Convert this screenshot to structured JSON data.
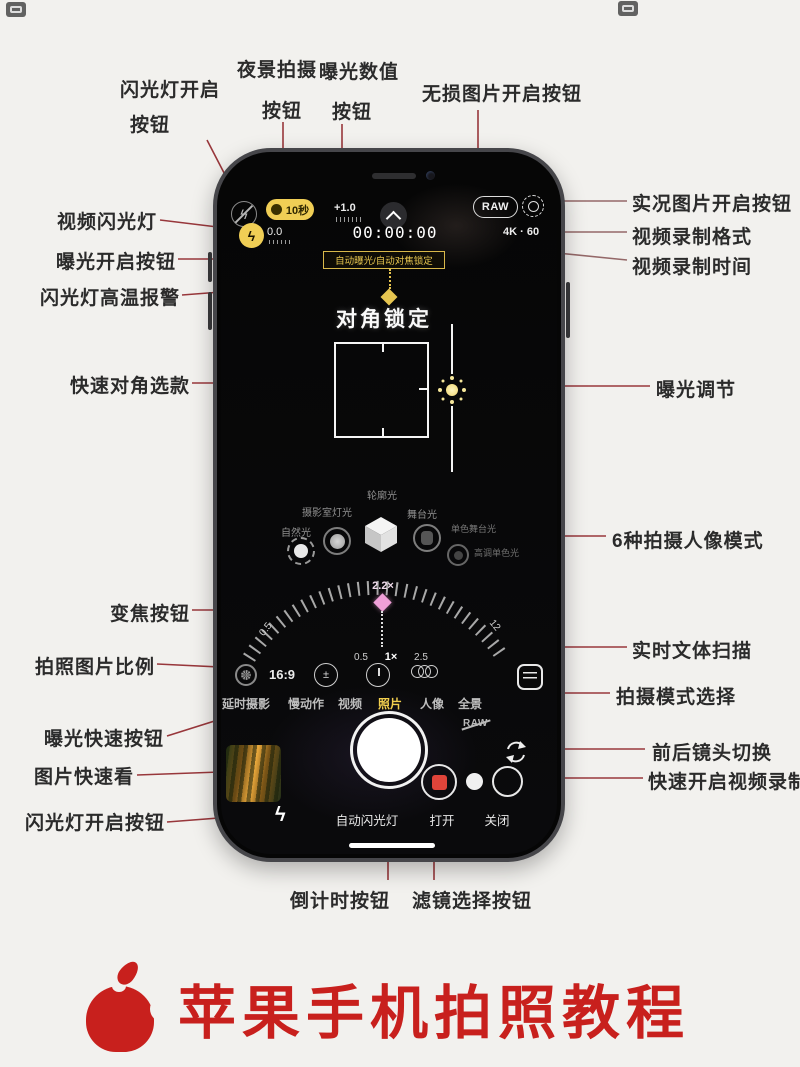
{
  "page": {
    "background": "#f2f1ee",
    "footer_title": "苹果手机拍照教程",
    "title_color": "#c8201d",
    "annotation_line_color": "#8f2328"
  },
  "annotations": {
    "top": [
      {
        "line1": "闪光灯开启",
        "line2": "按钮"
      },
      {
        "line1": "夜景拍摄",
        "line2": "按钮"
      },
      {
        "line1": "曝光数值",
        "line2": "按钮"
      },
      {
        "line1": "无损图片开启按钮",
        "line2": ""
      }
    ],
    "left": [
      "视频闪光灯",
      "曝光开启按钮",
      "闪光灯高温报警",
      "快速对角选款",
      "变焦按钮",
      "拍照图片比例",
      "曝光快速按钮",
      "图片快速看",
      "闪光灯开启按钮"
    ],
    "right": [
      "实况图片开启按钮",
      "视频录制格式",
      "视频录制时间",
      "曝光调节",
      "6种拍摄人像模式",
      "实时文体扫描",
      "拍摄模式选择",
      "前后镜头切换",
      "快速开启视频录制"
    ],
    "bottom": [
      "倒计时按钮",
      "滤镜选择按钮"
    ]
  },
  "camera": {
    "night_mode": "10秒",
    "exposure_value": "+1.0",
    "raw_badge": "RAW",
    "exposure_bias": "0.0",
    "record_time": "00:00:00",
    "video_format_res": "4K",
    "video_format_dot": "·",
    "video_format_fps": "60",
    "lock_banner": "自动曝光/自动对焦锁定",
    "focus_lock": "对角锁定",
    "portrait": {
      "contour": "轮廓光",
      "studio": "摄影室灯光",
      "natural": "自然光",
      "stage": "舞台光",
      "stage_mono": "单色舞台光",
      "high_key_mono": "高调单色光"
    },
    "zoom": {
      "current": "2.2×",
      "dial_min": "0.5",
      "dial_max": "12",
      "preset_low": "0.5",
      "preset_mid": "1×",
      "preset_high": "2.5"
    },
    "aspect_ratio": "16:9",
    "exposure_icon_glyph": "±",
    "raw_off": "RAW",
    "modes": [
      "延时摄影",
      "慢动作",
      "视频",
      "照片",
      "人像",
      "全景"
    ],
    "selected_mode": "照片",
    "flash_menu": {
      "auto": "自动闪光灯",
      "on": "打开",
      "off": "关闭"
    }
  },
  "colors": {
    "accent_yellow": "#f0ce55",
    "banner_yellow": "#e6c550",
    "record_red": "#e0443a",
    "zoom_marker_pink": "#f0a0d8",
    "selected_mode_yellow": "#f2cf4e",
    "phone_frame": "#46464a"
  }
}
